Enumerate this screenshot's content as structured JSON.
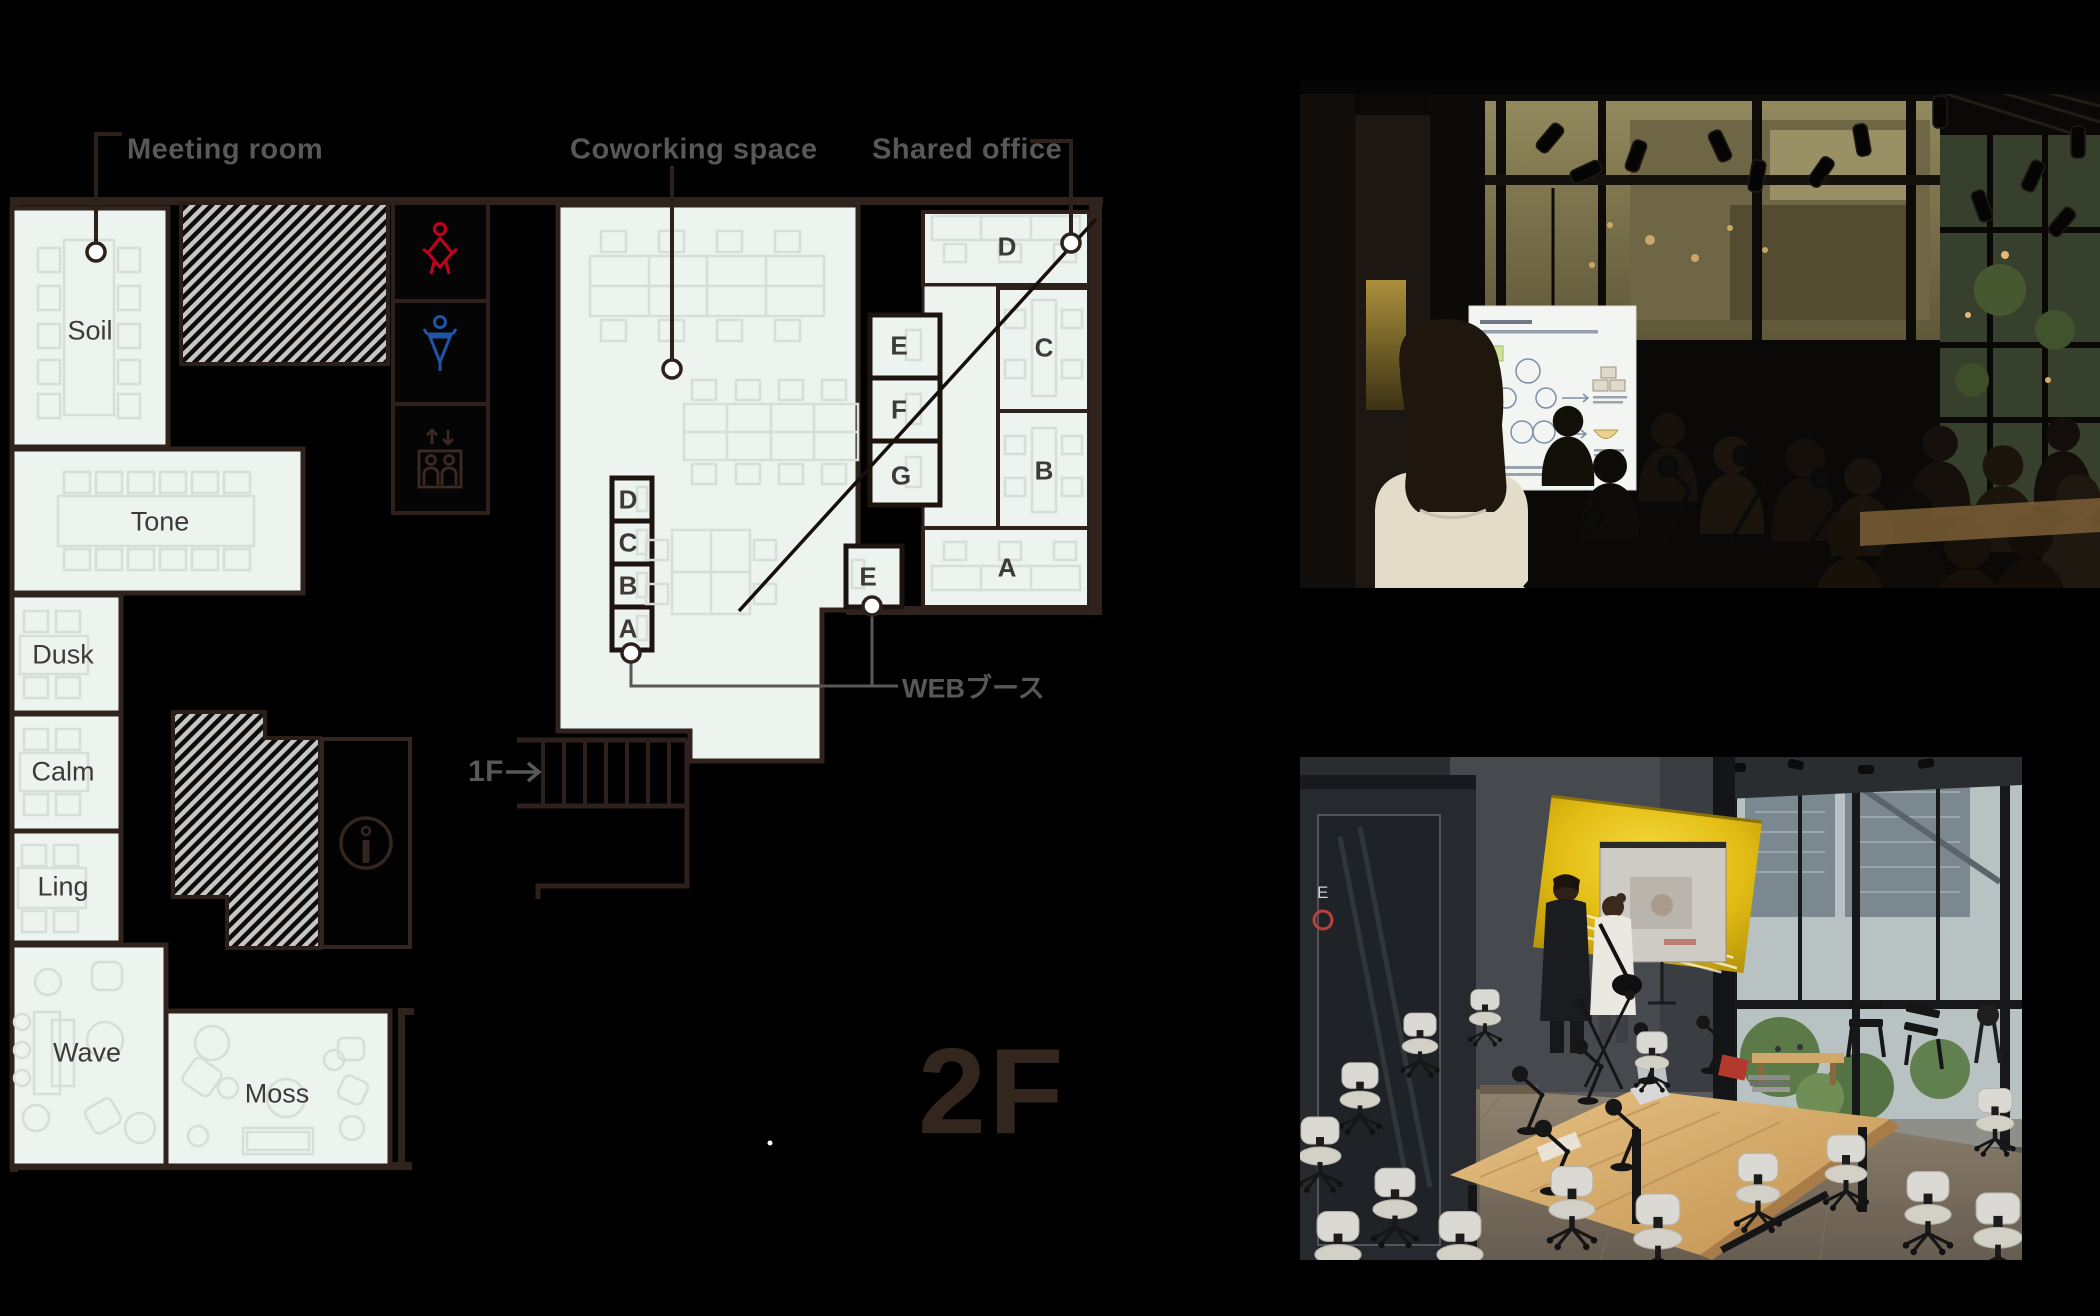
{
  "floorplan": {
    "floor_label": "2F",
    "labels": {
      "meeting_room": "Meeting room",
      "coworking": "Coworking space",
      "shared_office": "Shared office",
      "web_booth": "WEBブース",
      "stairs": "1F"
    },
    "rooms": {
      "soil": "Soil",
      "tone": "Tone",
      "dusk": "Dusk",
      "calm": "Calm",
      "ling": "Ling",
      "wave": "Wave",
      "moss": "Moss"
    },
    "web_booths": [
      "D",
      "C",
      "B",
      "A"
    ],
    "web_booth_e": "E",
    "shared_office_rooms": [
      "D",
      "C",
      "B",
      "A"
    ],
    "shared_office_booths": [
      "E",
      "F",
      "G"
    ],
    "icons": [
      "female-restroom-icon",
      "male-restroom-icon",
      "elevator-icon",
      "information-icon"
    ],
    "colors": {
      "room_fill": "#edf4f0",
      "wall_brown": "#30231d",
      "label_gray": "#595757",
      "letter_dark": "#3e3a39",
      "female_red": "#c4001f",
      "male_blue": "#1f55a5",
      "floor_label_brown": "#33261e"
    }
  },
  "photos": {
    "top": {
      "alt": "Evening seminar with presentation screen and audience"
    },
    "bottom": {
      "alt": "Daytime meeting room with wooden table and office chairs",
      "booth_label": "E"
    }
  }
}
